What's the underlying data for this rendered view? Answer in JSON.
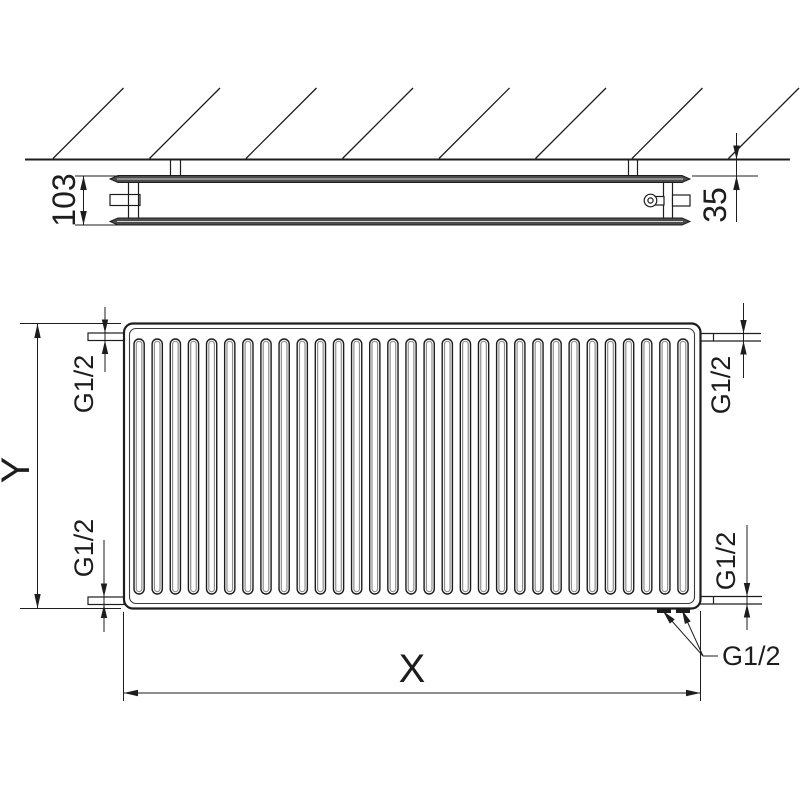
{
  "side_view": {
    "depth_dimension": "103",
    "wall_gap_dimension": "35",
    "wall_hatch_count": 8
  },
  "front_view": {
    "fin_count": 31,
    "height_dimension": "Y",
    "width_dimension": "X",
    "thread_top_left": "G1/2",
    "thread_top_right": "G1/2",
    "thread_bottom_left": "G1/2",
    "thread_bottom_right": "G1/2",
    "thread_bottom_ports": "G1/2"
  },
  "colors": {
    "line": "#1d1d1d",
    "panel_fill": "#4b4b4b",
    "panel_highlight": "#d0d0d0",
    "fin_shade": "#8f8f8f",
    "background": "#ffffff"
  }
}
